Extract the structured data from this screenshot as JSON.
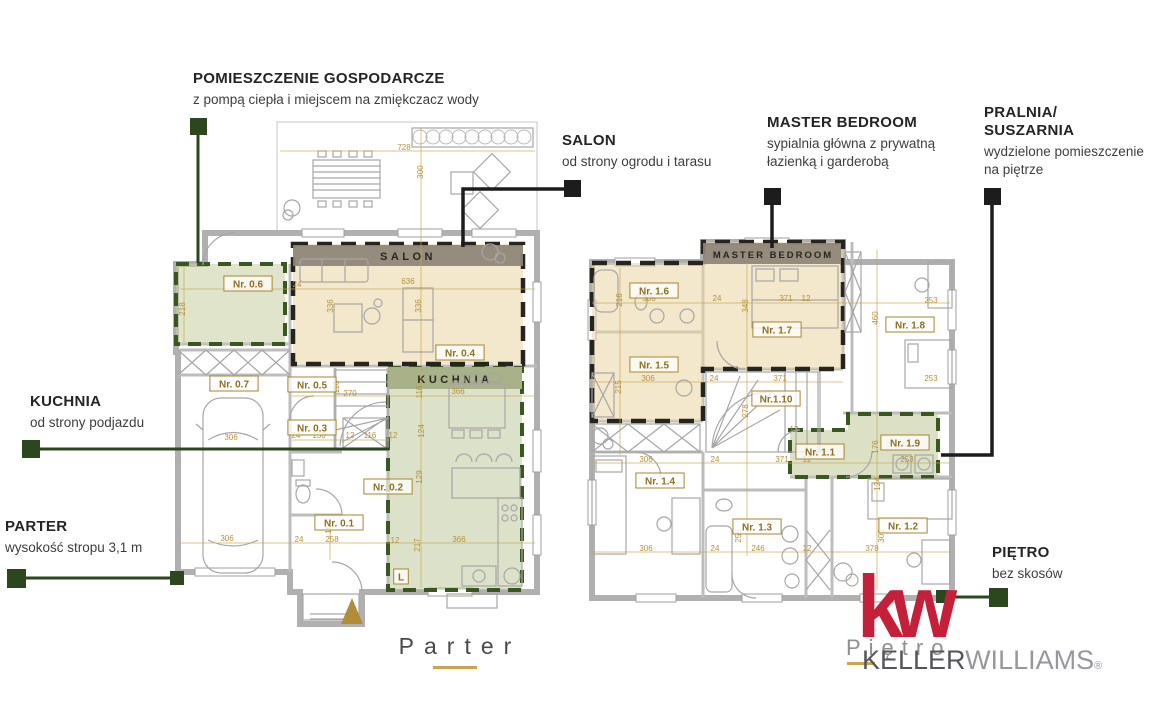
{
  "colors": {
    "accent_dark_green": "#2c471d",
    "callout_black": "#1c1c1c",
    "dimension_gold": "#b5913a",
    "sage_room_fill": "#dce3c9",
    "kitchen_band_olive": "#a9b188",
    "salon_band_taupe": "#8d8377",
    "beige_room_fill": "#f0e6c8",
    "logo_red": "#c5203a",
    "keller_gray": "#55565a",
    "williams_gray": "#97989c"
  },
  "callouts": [
    {
      "id": "pomieszczenie-gospodarcze",
      "title": "POMIESZCZENIE GOSPODARCZE",
      "subtitle": "z pompą ciepła i miejscem na zmiękczacz wody",
      "marker_color": "green"
    },
    {
      "id": "salon",
      "title": "SALON",
      "subtitle": "od strony ogrodu i tarasu",
      "marker_color": "black"
    },
    {
      "id": "master-bedroom",
      "title": "MASTER BEDROOM",
      "subtitle": "sypialnia główna z prywatną\nłazienką i garderobą",
      "marker_color": "black"
    },
    {
      "id": "pralnia-suszarnia",
      "title": "PRALNIA/\nSUSZARNIA",
      "subtitle": "wydzielone pomieszczenie\nna piętrze",
      "marker_color": "black"
    },
    {
      "id": "kuchnia",
      "title": "KUCHNIA",
      "subtitle": "od strony podjazdu",
      "marker_color": "green"
    },
    {
      "id": "parter",
      "title": "PARTER",
      "subtitle": "wysokość stropu 3,1 m",
      "marker_color": "green"
    },
    {
      "id": "pietro",
      "title": "PIĘTRO",
      "subtitle": "bez skosów",
      "marker_color": "green"
    }
  ],
  "plans": {
    "parter": {
      "title": "Parter",
      "bands": {
        "salon": "SALON",
        "kuchnia": "KUCHNIA"
      },
      "room_numbers": [
        {
          "label": "Nr. 0.6",
          "x": 248,
          "y": 284
        },
        {
          "label": "Nr. 0.4",
          "x": 460,
          "y": 353
        },
        {
          "label": "Nr. 0.7",
          "x": 234,
          "y": 384
        },
        {
          "label": "Nr. 0.5",
          "x": 312,
          "y": 385
        },
        {
          "label": "Nr. 0.3",
          "x": 312,
          "y": 428
        },
        {
          "label": "Nr. 0.2",
          "x": 388,
          "y": 487
        },
        {
          "label": "Nr. 0.1",
          "x": 339,
          "y": 523
        },
        {
          "label": "L",
          "x": 401,
          "y": 577
        }
      ],
      "dimensions": [
        {
          "v": "728",
          "x": 404,
          "y": 150
        },
        {
          "v": "300",
          "x": 423,
          "y": 172,
          "r": 1
        },
        {
          "v": "306",
          "x": 258,
          "y": 286
        },
        {
          "v": "24",
          "x": 297,
          "y": 287
        },
        {
          "v": "636",
          "x": 408,
          "y": 284
        },
        {
          "v": "218",
          "x": 185,
          "y": 309,
          "r": 1
        },
        {
          "v": "336",
          "x": 333,
          "y": 306,
          "r": 1
        },
        {
          "v": "336",
          "x": 421,
          "y": 306,
          "r": 1
        },
        {
          "v": "306",
          "x": 231,
          "y": 440
        },
        {
          "v": "116",
          "x": 339,
          "y": 387,
          "r": 1
        },
        {
          "v": "270",
          "x": 350,
          "y": 396
        },
        {
          "v": "366",
          "x": 458,
          "y": 394
        },
        {
          "v": "116",
          "x": 422,
          "y": 392,
          "r": 1
        },
        {
          "v": "24",
          "x": 296,
          "y": 438
        },
        {
          "v": "150",
          "x": 319,
          "y": 438
        },
        {
          "v": "12",
          "x": 350,
          "y": 438
        },
        {
          "v": "116",
          "x": 370,
          "y": 438
        },
        {
          "v": "12",
          "x": 393,
          "y": 438
        },
        {
          "v": "124",
          "x": 424,
          "y": 431,
          "r": 1
        },
        {
          "v": "129",
          "x": 422,
          "y": 477,
          "r": 1
        },
        {
          "v": "165",
          "x": 331,
          "y": 527,
          "r": 1
        },
        {
          "v": "306",
          "x": 227,
          "y": 541
        },
        {
          "v": "24",
          "x": 299,
          "y": 542
        },
        {
          "v": "258",
          "x": 332,
          "y": 542
        },
        {
          "v": "12",
          "x": 395,
          "y": 543
        },
        {
          "v": "217",
          "x": 420,
          "y": 545,
          "r": 1
        },
        {
          "v": "366",
          "x": 459,
          "y": 542
        }
      ]
    },
    "pietro": {
      "title": "Piętro",
      "bands": {
        "master": "MASTER BEDROOM"
      },
      "room_numbers": [
        {
          "label": "Nr. 1.6",
          "x": 654,
          "y": 291
        },
        {
          "label": "Nr. 1.5",
          "x": 654,
          "y": 365
        },
        {
          "label": "Nr. 1.7",
          "x": 777,
          "y": 330
        },
        {
          "label": "Nr. 1.8",
          "x": 910,
          "y": 325
        },
        {
          "label": "Nr.1.10",
          "x": 776,
          "y": 399
        },
        {
          "label": "Nr. 1.1",
          "x": 820,
          "y": 452
        },
        {
          "label": "Nr. 1.9",
          "x": 905,
          "y": 443
        },
        {
          "label": "Nr. 1.4",
          "x": 660,
          "y": 481
        },
        {
          "label": "Nr. 1.3",
          "x": 757,
          "y": 527
        },
        {
          "label": "Nr. 1.2",
          "x": 903,
          "y": 526
        }
      ],
      "dimensions": [
        {
          "v": "216",
          "x": 622,
          "y": 300,
          "r": 1
        },
        {
          "v": "306",
          "x": 649,
          "y": 301
        },
        {
          "v": "24",
          "x": 717,
          "y": 301
        },
        {
          "v": "348",
          "x": 748,
          "y": 306,
          "r": 1
        },
        {
          "v": "371",
          "x": 786,
          "y": 301
        },
        {
          "v": "12",
          "x": 806,
          "y": 301
        },
        {
          "v": "253",
          "x": 931,
          "y": 303
        },
        {
          "v": "460",
          "x": 878,
          "y": 318,
          "r": 1
        },
        {
          "v": "253",
          "x": 931,
          "y": 381
        },
        {
          "v": "215",
          "x": 621,
          "y": 387,
          "r": 1
        },
        {
          "v": "306",
          "x": 648,
          "y": 381
        },
        {
          "v": "24",
          "x": 714,
          "y": 381
        },
        {
          "v": "371",
          "x": 780,
          "y": 381
        },
        {
          "v": "278",
          "x": 748,
          "y": 411,
          "r": 1
        },
        {
          "v": "12",
          "x": 794,
          "y": 432
        },
        {
          "v": "176",
          "x": 878,
          "y": 447,
          "r": 1
        },
        {
          "v": "253",
          "x": 907,
          "y": 462
        },
        {
          "v": "306",
          "x": 646,
          "y": 462
        },
        {
          "v": "24",
          "x": 715,
          "y": 462
        },
        {
          "v": "371",
          "x": 782,
          "y": 462
        },
        {
          "v": "12",
          "x": 807,
          "y": 462
        },
        {
          "v": "124",
          "x": 880,
          "y": 484,
          "r": 1
        },
        {
          "v": "306",
          "x": 646,
          "y": 551
        },
        {
          "v": "24",
          "x": 715,
          "y": 551
        },
        {
          "v": "246",
          "x": 758,
          "y": 551
        },
        {
          "v": "12",
          "x": 807,
          "y": 551
        },
        {
          "v": "378",
          "x": 872,
          "y": 551
        },
        {
          "v": "306",
          "x": 884,
          "y": 536,
          "r": 1
        },
        {
          "v": "256",
          "x": 741,
          "y": 536,
          "r": 1
        }
      ]
    }
  },
  "footer": {
    "parter_title": "Parter",
    "pietro_caption": "Piętro",
    "logo_kw": "kw",
    "logo_keller": "KELLER",
    "logo_williams": "WILLIAMS",
    "logo_reg": "®"
  }
}
